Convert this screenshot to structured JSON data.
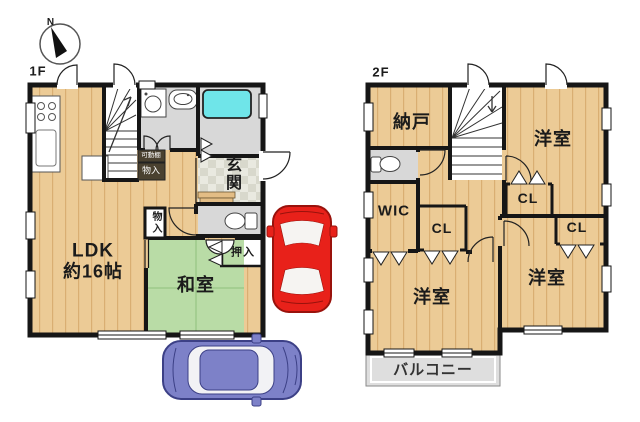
{
  "compass": {
    "north": "N"
  },
  "floor1": {
    "label": "1F",
    "rooms": {
      "ldk": {
        "name": "LDK",
        "size": "約16帖"
      },
      "washitsu": {
        "name": "和室"
      },
      "genkan": {
        "name": "玄関"
      },
      "oshiire": {
        "name": "押入"
      },
      "kadoudana": {
        "name": "可動棚"
      },
      "monoire_shelf": {
        "name": "物入"
      },
      "monoire_closet": {
        "name": "物入"
      }
    }
  },
  "floor2": {
    "label": "2F",
    "rooms": {
      "nando": {
        "name": "納戸"
      },
      "yoshitsu_ne": {
        "name": "洋室"
      },
      "yoshitsu_sw": {
        "name": "洋室"
      },
      "yoshitsu_se": {
        "name": "洋室"
      },
      "wic": {
        "name": "WIC"
      },
      "cl_hall": {
        "name": "CL"
      },
      "cl_ne": {
        "name": "CL"
      },
      "cl_se": {
        "name": "CL"
      },
      "balcony": {
        "name": "バルコニー"
      }
    }
  },
  "colors": {
    "wall": "#161616",
    "wood_floor": "#eccb96",
    "tatami_green": "#b9dca6",
    "tile_gray": "#d8d8d8",
    "bathtub_cyan": "#6fe5e9",
    "balcony_gray": "#dedede",
    "car_red": "#e8211a",
    "car_blue": "#7d81c8"
  }
}
